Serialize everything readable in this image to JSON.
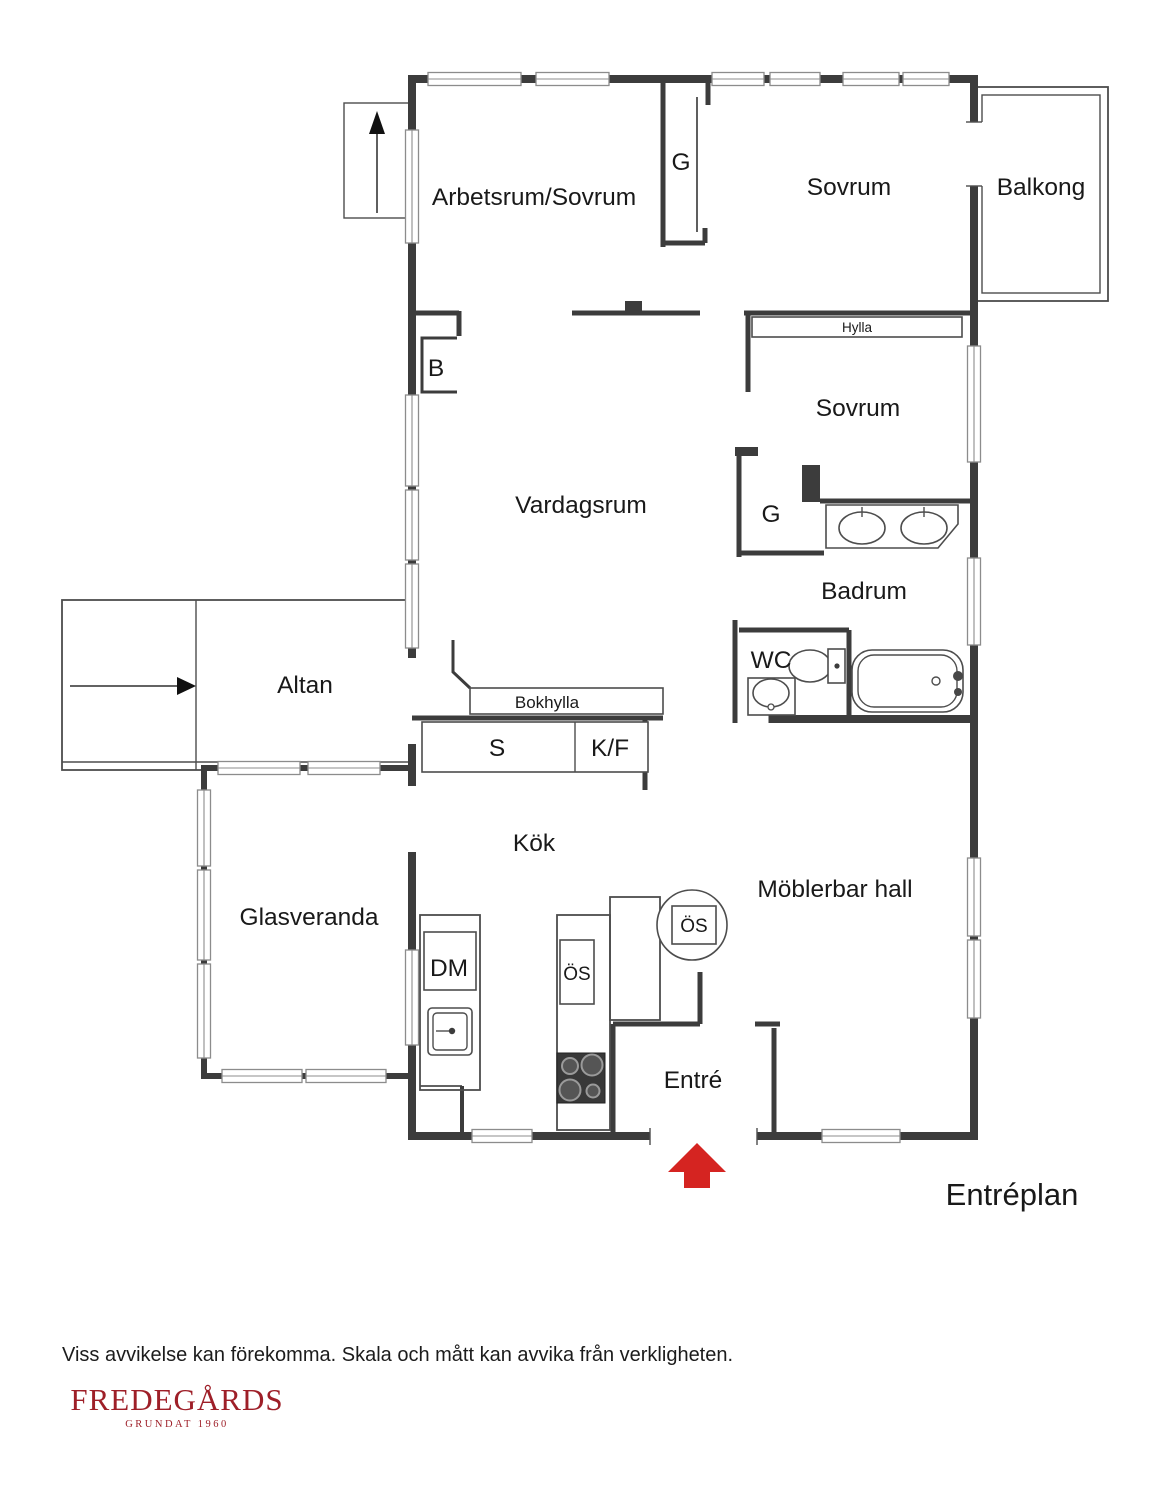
{
  "floor_plan": {
    "title": "Entréplan",
    "rooms": {
      "arbetsrum_sovrum": "Arbetsrum/Sovrum",
      "sovrum_1": "Sovrum",
      "balkong": "Balkong",
      "sovrum_2": "Sovrum",
      "vardagsrum": "Vardagsrum",
      "badrum": "Badrum",
      "wc": "WC",
      "altan": "Altan",
      "kok": "Kök",
      "glasveranda": "Glasveranda",
      "moblerbar_hall": "Möblerbar hall",
      "entre": "Entré"
    },
    "fixtures": {
      "garderob_1": "G",
      "garderob_2": "G",
      "b_closet": "B",
      "hylla": "Hylla",
      "bokhylla": "Bokhylla",
      "skafferi": "S",
      "kyl_frys": "K/F",
      "diskmaskin": "DM",
      "ugn": "ÖS",
      "oppen_spis": "ÖS"
    },
    "colors": {
      "wall": "#3c3c3c",
      "entry_arrow": "#d52421",
      "brand": "#9e1f28"
    }
  },
  "footer": {
    "disclaimer": "Viss avvikelse kan förekomma. Skala och mått kan avvika från verkligheten.",
    "brand_name": "FREDEGÅRDS",
    "brand_tagline": "GRUNDAT 1960"
  }
}
